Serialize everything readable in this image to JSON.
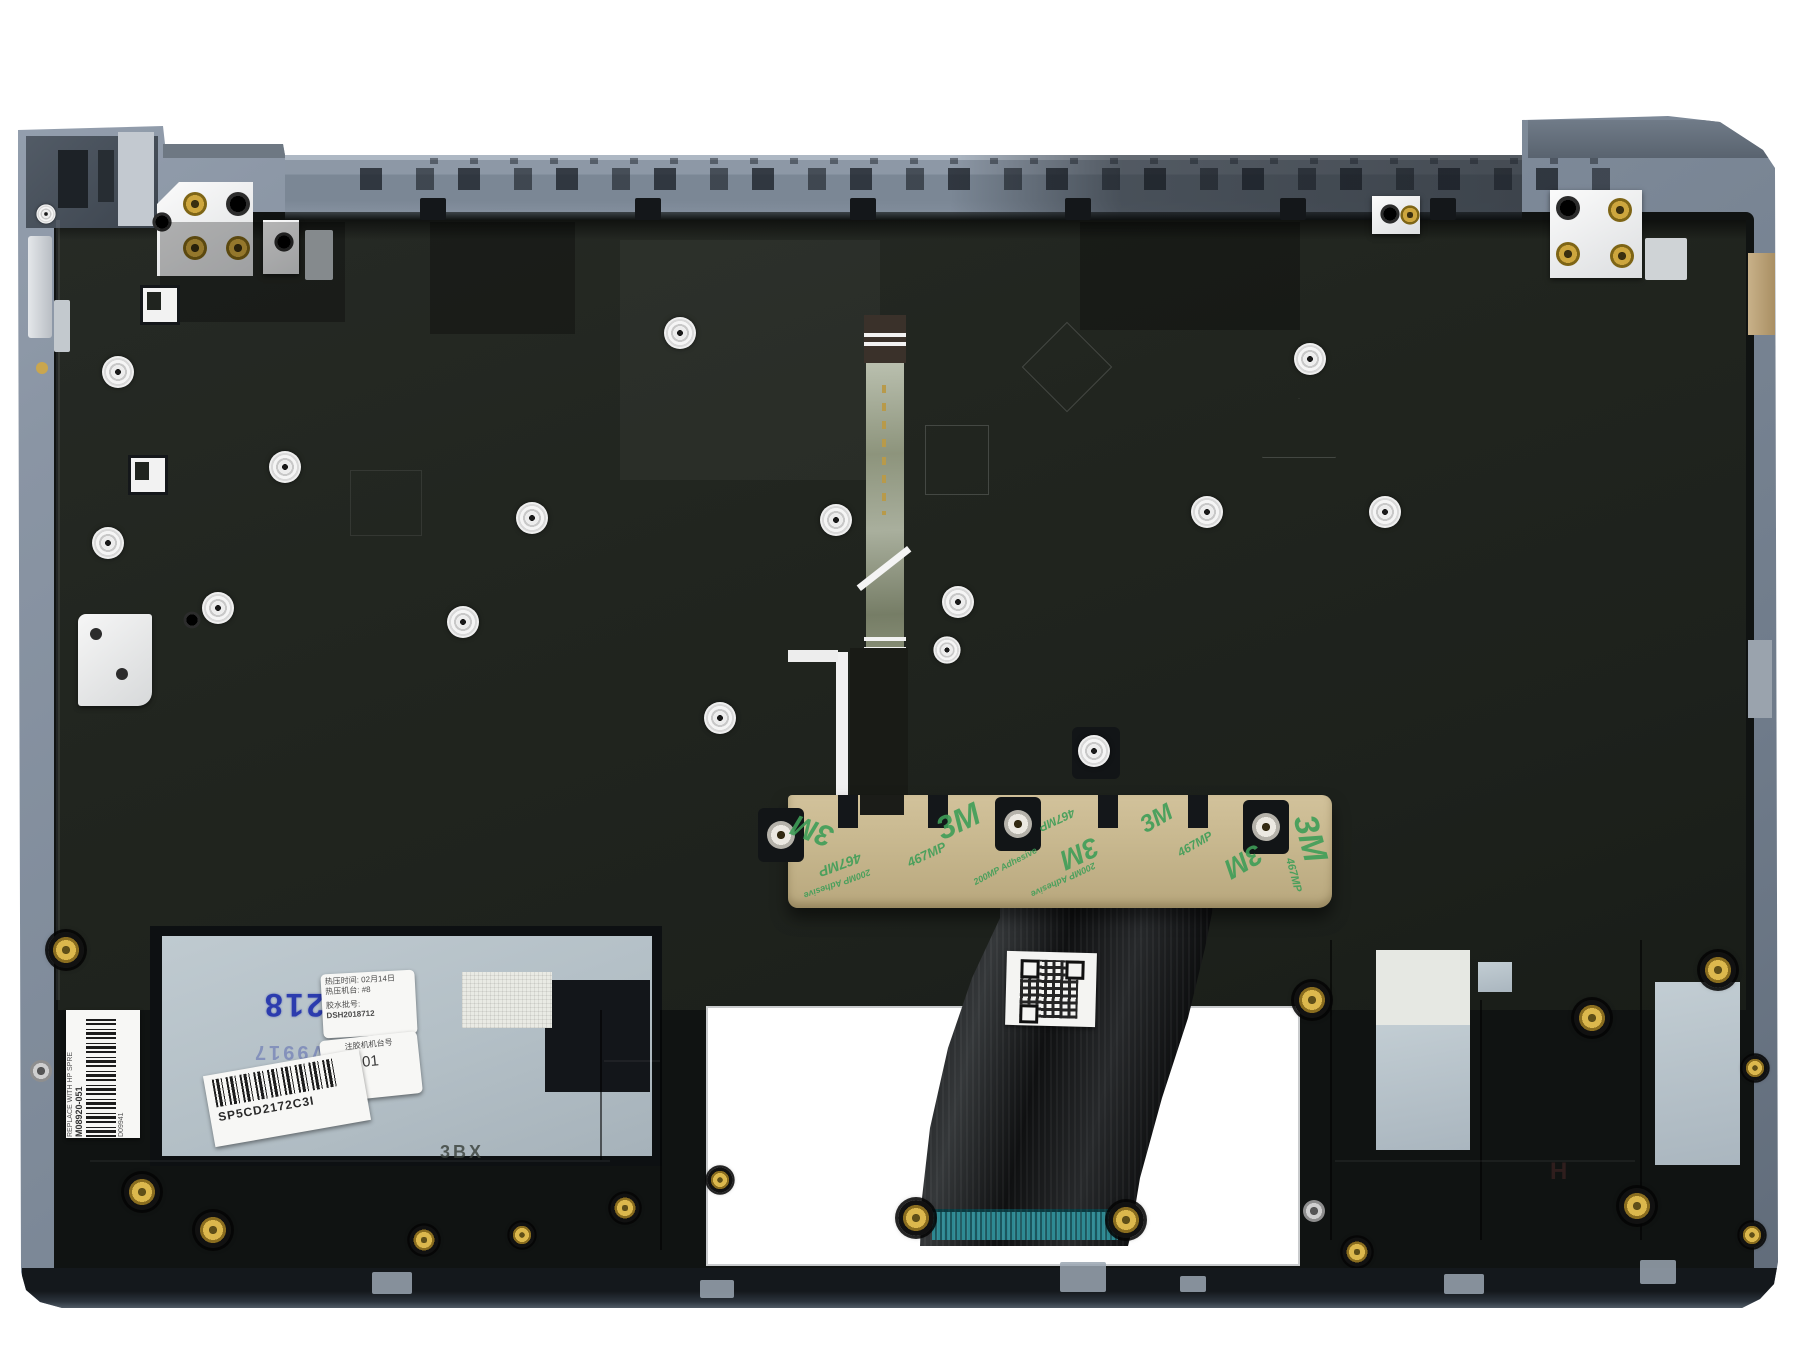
{
  "scene": {
    "type": "product-photo",
    "subject": "Laptop palmrest top-case assembly, internal side, with black keyboard backplate, backlight ribbon cable, 3M adhesive strip and factory service labels",
    "background_color": "#ffffff"
  },
  "colors": {
    "chassis_blue_grey": "#8a95a4",
    "keyboard_plate": "#21251f",
    "tape_tan": "#c7b78e",
    "tape_print_green": "#3f9e58",
    "touchpad_region_blue": "#b3bfc6",
    "stamp_blue": "#2c3cae",
    "ribbon_black": "#121315",
    "connector_teal": "#2e8a93",
    "brass_gold": "#cda63e"
  },
  "labels": {
    "hp_spare": {
      "line1": "REPLACE WITH HP SPRE",
      "line2": "M08920-051",
      "serial": "D09941"
    },
    "blue_stamp": "2 218",
    "faint_stamp": "ZV9917",
    "process_sticker": {
      "line1": "热压时间: 02月14日",
      "line2": "热压机台: #8",
      "line3": "胶水批号:",
      "line4": "DSH2018712"
    },
    "station_sticker": {
      "title": "注胶机机台号",
      "value": "01"
    },
    "barcode_sticker": {
      "code": "SP5CD2172C3I"
    },
    "adhesive_tape": {
      "brand": "3M",
      "model": "467MP",
      "type": "200MP Adhesive"
    },
    "embossed_mark": "3BX",
    "embossed_h": "H"
  }
}
